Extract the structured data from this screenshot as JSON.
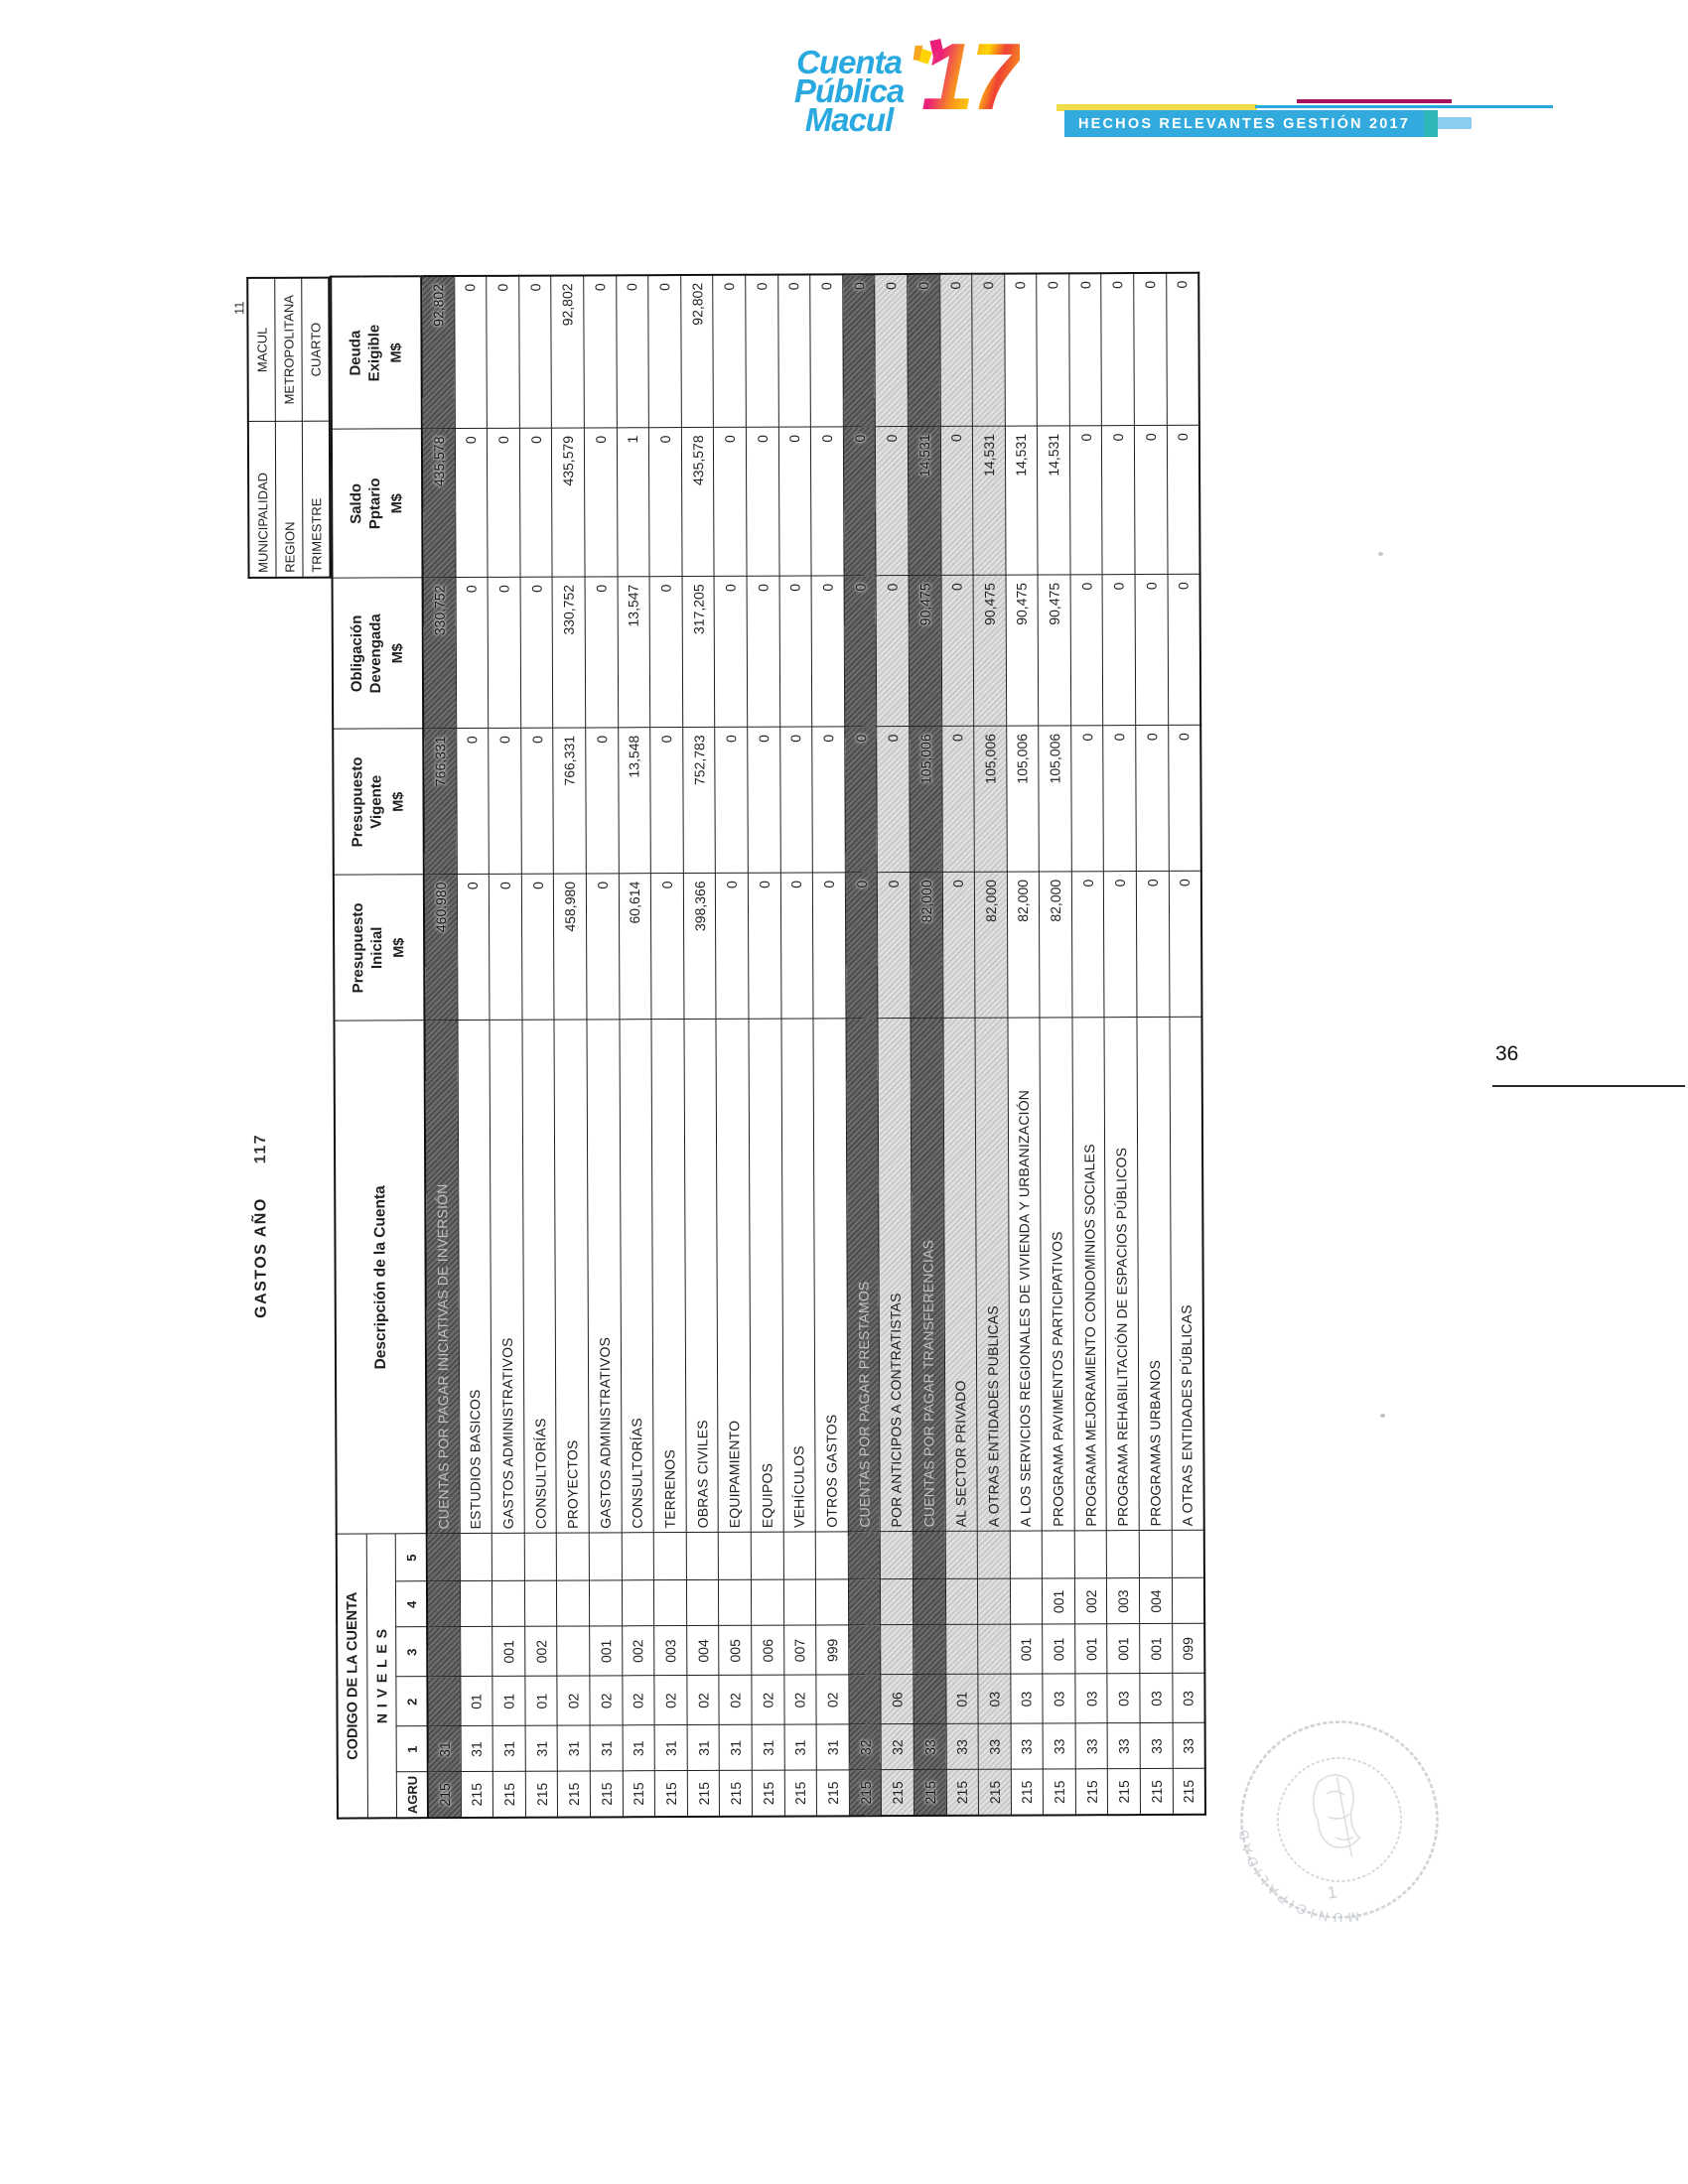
{
  "page": {
    "sheet_number": "11",
    "folio": "36"
  },
  "logo": {
    "word1": "Cuenta",
    "word2": "Pública",
    "word3": "Macul",
    "apostrophe": "'",
    "year": "17",
    "banner": "HECHOS RELEVANTES GESTIÓN 2017",
    "colors": {
      "brand_blue": "#2aa9e0",
      "banner_blue": "#33aadd",
      "accent_yellow": "#f2dc4a",
      "accent_magenta": "#a81060",
      "accent_teal": "#2fb6b9"
    }
  },
  "report": {
    "title": "GASTOS AÑO",
    "year_fragment": "117"
  },
  "info_box": {
    "rows": [
      {
        "label": "MUNICIPALIDAD",
        "value": "MACUL"
      },
      {
        "label": "REGION",
        "value": "METROPOLITANA"
      },
      {
        "label": "TRIMESTRE",
        "value": "CUARTO"
      }
    ]
  },
  "table": {
    "code_header": {
      "title": "CODIGO DE LA CUENTA",
      "subtitle": "N I V E L E S",
      "levels": [
        "AGRU",
        "1",
        "2",
        "3",
        "4",
        "5"
      ]
    },
    "desc_header": "Descripción de la Cuenta",
    "value_headers": [
      {
        "l1": "Presupuesto",
        "l2": "Inicial",
        "unit": "M$"
      },
      {
        "l1": "Presupuesto",
        "l2": "Vigente",
        "unit": "M$"
      },
      {
        "l1": "Obligación",
        "l2": "Devengada",
        "unit": "M$"
      },
      {
        "l1": "Saldo",
        "l2": "Pptario",
        "unit": "M$"
      },
      {
        "l1": "Deuda",
        "l2": "Exigible",
        "unit": "M$"
      }
    ],
    "rows": [
      {
        "agru": "215",
        "n1": "31",
        "n2": "",
        "n3": "",
        "n4": "",
        "n5": "",
        "desc": "CUENTAS POR PAGAR INICIATIVAS DE INVERSIÓN",
        "ini": "460,980",
        "vig": "766,331",
        "obl": "330,752",
        "sal": "435,578",
        "deu": "92,802",
        "shade": "dark"
      },
      {
        "agru": "215",
        "n1": "31",
        "n2": "01",
        "n3": "",
        "n4": "",
        "n5": "",
        "desc": "ESTUDIOS BASICOS",
        "ini": "0",
        "vig": "0",
        "obl": "0",
        "sal": "0",
        "deu": "0",
        "shade": ""
      },
      {
        "agru": "215",
        "n1": "31",
        "n2": "01",
        "n3": "001",
        "n4": "",
        "n5": "",
        "desc": "GASTOS ADMINISTRATIVOS",
        "ini": "0",
        "vig": "0",
        "obl": "0",
        "sal": "0",
        "deu": "0",
        "shade": ""
      },
      {
        "agru": "215",
        "n1": "31",
        "n2": "01",
        "n3": "002",
        "n4": "",
        "n5": "",
        "desc": "CONSULTORÍAS",
        "ini": "0",
        "vig": "0",
        "obl": "0",
        "sal": "0",
        "deu": "0",
        "shade": ""
      },
      {
        "agru": "215",
        "n1": "31",
        "n2": "02",
        "n3": "",
        "n4": "",
        "n5": "",
        "desc": "PROYECTOS",
        "ini": "458,980",
        "vig": "766,331",
        "obl": "330,752",
        "sal": "435,579",
        "deu": "92,802",
        "shade": ""
      },
      {
        "agru": "215",
        "n1": "31",
        "n2": "02",
        "n3": "001",
        "n4": "",
        "n5": "",
        "desc": "GASTOS ADMINISTRATIVOS",
        "ini": "0",
        "vig": "0",
        "obl": "0",
        "sal": "0",
        "deu": "0",
        "shade": ""
      },
      {
        "agru": "215",
        "n1": "31",
        "n2": "02",
        "n3": "002",
        "n4": "",
        "n5": "",
        "desc": "CONSULTORÍAS",
        "ini": "60,614",
        "vig": "13,548",
        "obl": "13,547",
        "sal": "1",
        "deu": "0",
        "shade": ""
      },
      {
        "agru": "215",
        "n1": "31",
        "n2": "02",
        "n3": "003",
        "n4": "",
        "n5": "",
        "desc": "TERRENOS",
        "ini": "0",
        "vig": "0",
        "obl": "0",
        "sal": "0",
        "deu": "0",
        "shade": ""
      },
      {
        "agru": "215",
        "n1": "31",
        "n2": "02",
        "n3": "004",
        "n4": "",
        "n5": "",
        "desc": "OBRAS CIVILES",
        "ini": "398,366",
        "vig": "752,783",
        "obl": "317,205",
        "sal": "435,578",
        "deu": "92,802",
        "shade": ""
      },
      {
        "agru": "215",
        "n1": "31",
        "n2": "02",
        "n3": "005",
        "n4": "",
        "n5": "",
        "desc": "EQUIPAMIENTO",
        "ini": "0",
        "vig": "0",
        "obl": "0",
        "sal": "0",
        "deu": "0",
        "shade": ""
      },
      {
        "agru": "215",
        "n1": "31",
        "n2": "02",
        "n3": "006",
        "n4": "",
        "n5": "",
        "desc": "EQUIPOS",
        "ini": "0",
        "vig": "0",
        "obl": "0",
        "sal": "0",
        "deu": "0",
        "shade": ""
      },
      {
        "agru": "215",
        "n1": "31",
        "n2": "02",
        "n3": "007",
        "n4": "",
        "n5": "",
        "desc": "VEHÍCULOS",
        "ini": "0",
        "vig": "0",
        "obl": "0",
        "sal": "0",
        "deu": "0",
        "shade": ""
      },
      {
        "agru": "215",
        "n1": "31",
        "n2": "02",
        "n3": "999",
        "n4": "",
        "n5": "",
        "desc": "OTROS GASTOS",
        "ini": "0",
        "vig": "0",
        "obl": "0",
        "sal": "0",
        "deu": "0",
        "shade": ""
      },
      {
        "agru": "215",
        "n1": "32",
        "n2": "",
        "n3": "",
        "n4": "",
        "n5": "",
        "desc": "CUENTAS POR PAGAR PRESTAMOS",
        "ini": "0",
        "vig": "0",
        "obl": "0",
        "sal": "0",
        "deu": "0",
        "shade": "dark"
      },
      {
        "agru": "215",
        "n1": "32",
        "n2": "06",
        "n3": "",
        "n4": "",
        "n5": "",
        "desc": "POR ANTICIPOS A CONTRATISTAS",
        "ini": "0",
        "vig": "0",
        "obl": "0",
        "sal": "0",
        "deu": "0",
        "shade": "light"
      },
      {
        "agru": "215",
        "n1": "33",
        "n2": "",
        "n3": "",
        "n4": "",
        "n5": "",
        "desc": "CUENTAS POR PAGAR TRANSFERENCIAS",
        "ini": "82,000",
        "vig": "105,006",
        "obl": "90,475",
        "sal": "14,531",
        "deu": "0",
        "shade": "dark"
      },
      {
        "agru": "215",
        "n1": "33",
        "n2": "01",
        "n3": "",
        "n4": "",
        "n5": "",
        "desc": "AL SECTOR PRIVADO",
        "ini": "0",
        "vig": "0",
        "obl": "0",
        "sal": "0",
        "deu": "0",
        "shade": "light"
      },
      {
        "agru": "215",
        "n1": "33",
        "n2": "03",
        "n3": "",
        "n4": "",
        "n5": "",
        "desc": "A OTRAS ENTIDADES PUBLICAS",
        "ini": "82,000",
        "vig": "105,006",
        "obl": "90,475",
        "sal": "14,531",
        "deu": "0",
        "shade": "light"
      },
      {
        "agru": "215",
        "n1": "33",
        "n2": "03",
        "n3": "001",
        "n4": "",
        "n5": "",
        "desc": "A LOS SERVICIOS REGIONALES DE VIVIENDA Y URBANIZACIÓN",
        "ini": "82,000",
        "vig": "105,006",
        "obl": "90,475",
        "sal": "14,531",
        "deu": "0",
        "shade": ""
      },
      {
        "agru": "215",
        "n1": "33",
        "n2": "03",
        "n3": "001",
        "n4": "001",
        "n5": "",
        "desc": "PROGRAMA PAVIMENTOS PARTICIPATIVOS",
        "ini": "82,000",
        "vig": "105,006",
        "obl": "90,475",
        "sal": "14,531",
        "deu": "0",
        "shade": ""
      },
      {
        "agru": "215",
        "n1": "33",
        "n2": "03",
        "n3": "001",
        "n4": "002",
        "n5": "",
        "desc": "PROGRAMA MEJORAMIENTO CONDOMINIOS SOCIALES",
        "ini": "0",
        "vig": "0",
        "obl": "0",
        "sal": "0",
        "deu": "0",
        "shade": ""
      },
      {
        "agru": "215",
        "n1": "33",
        "n2": "03",
        "n3": "001",
        "n4": "003",
        "n5": "",
        "desc": "PROGRAMA REHABILITACIÓN DE ESPACIOS PÚBLICOS",
        "ini": "0",
        "vig": "0",
        "obl": "0",
        "sal": "0",
        "deu": "0",
        "shade": ""
      },
      {
        "agru": "215",
        "n1": "33",
        "n2": "03",
        "n3": "001",
        "n4": "004",
        "n5": "",
        "desc": "PROGRAMAS URBANOS",
        "ini": "0",
        "vig": "0",
        "obl": "0",
        "sal": "0",
        "deu": "0",
        "shade": ""
      },
      {
        "agru": "215",
        "n1": "33",
        "n2": "03",
        "n3": "099",
        "n4": "",
        "n5": "",
        "desc": "A OTRAS ENTIDADES PÚBLICAS",
        "ini": "0",
        "vig": "0",
        "obl": "0",
        "sal": "0",
        "deu": "0",
        "shade": ""
      }
    ]
  },
  "stamp": {
    "rim_text": "MUNICIPALIDAD",
    "digit": "1"
  }
}
